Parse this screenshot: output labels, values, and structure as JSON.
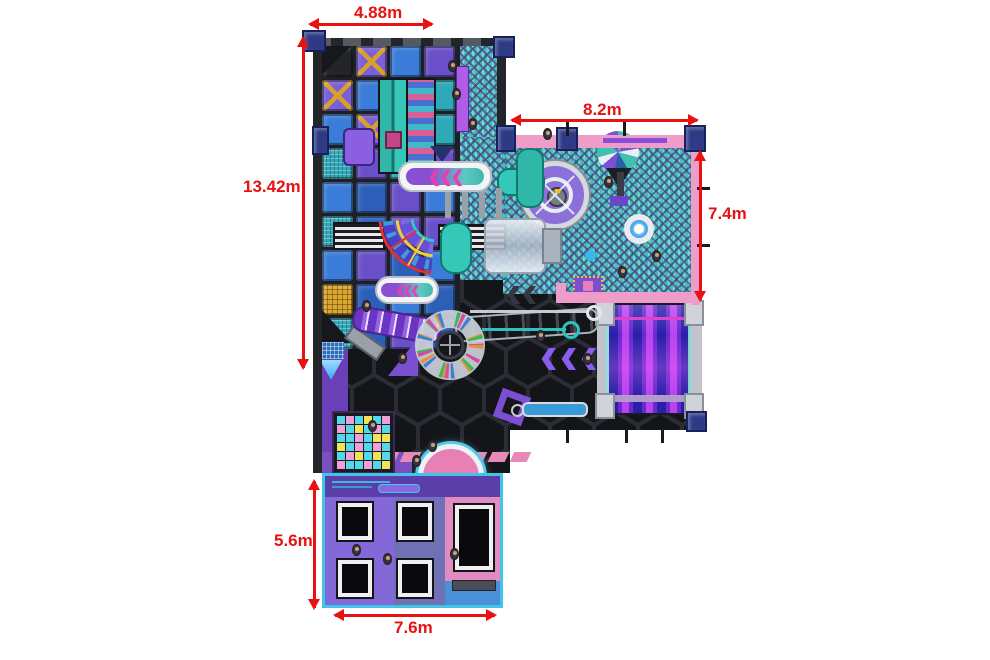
{
  "page": {
    "background": "#ffffff",
    "description": "Indoor playground floor plan, top view"
  },
  "dimensions": {
    "top_width": {
      "label": "4.88m"
    },
    "left_height": {
      "label": "13.42m"
    },
    "ballpit_width": {
      "label": "8.2m"
    },
    "ballpit_height": {
      "label": "7.4m"
    },
    "trampoline_height": {
      "label": "5.6m"
    },
    "trampoline_width": {
      "label": "7.6m"
    }
  },
  "badge": {
    "text": "SPORT"
  },
  "colors": {
    "dimension_red": "#e81212",
    "pink_wall": "#ee9cc8",
    "navy_pillar": "#2e3a85",
    "ballpit_teal": "#45c2b2",
    "hex_floor": "#141519",
    "purple_floor": "#6a3fb8",
    "slide_purple_dark": "#2920a8",
    "slide_purple_bright": "#b844ee",
    "cyan_border": "#40c4e8",
    "deck_purple": "#7a5fd0",
    "trampoline_pink": "#e08cc0"
  },
  "structure_grid": {
    "rows": [
      "d,P,b,p",
      "P,b,t,t",
      "b,P,t,t",
      "T,p,t,p",
      "b,B,p,b",
      "T,B,p,p",
      "b,p,B,b",
      "g,B,b,B",
      "T,B,p,B"
    ]
  },
  "interactive_floor": {
    "rows": [
      "cpcycp",
      "pcycpc",
      "ccpcyy",
      "ycpcpc",
      "cpycyc",
      "pccpcy"
    ],
    "palette": {
      "c": "#52d8e8",
      "p": "#f0a0d8",
      "y": "#f2e255"
    }
  },
  "trampolines": [
    {
      "x": 16,
      "y": 30,
      "w": 34,
      "h": 37
    },
    {
      "x": 76,
      "y": 30,
      "w": 34,
      "h": 37
    },
    {
      "x": 133,
      "y": 32,
      "w": 38,
      "h": 65
    },
    {
      "x": 16,
      "y": 87,
      "w": 34,
      "h": 37
    },
    {
      "x": 76,
      "y": 87,
      "w": 34,
      "h": 37
    }
  ],
  "people": [
    [
      448,
      60
    ],
    [
      452,
      88
    ],
    [
      468,
      118
    ],
    [
      543,
      128
    ],
    [
      604,
      176
    ],
    [
      652,
      250
    ],
    [
      618,
      266
    ],
    [
      362,
      300
    ],
    [
      398,
      352
    ],
    [
      368,
      420
    ],
    [
      428,
      440
    ],
    [
      536,
      330
    ],
    [
      583,
      353
    ],
    [
      352,
      544
    ],
    [
      383,
      553
    ],
    [
      450,
      548
    ],
    [
      412,
      455
    ]
  ]
}
